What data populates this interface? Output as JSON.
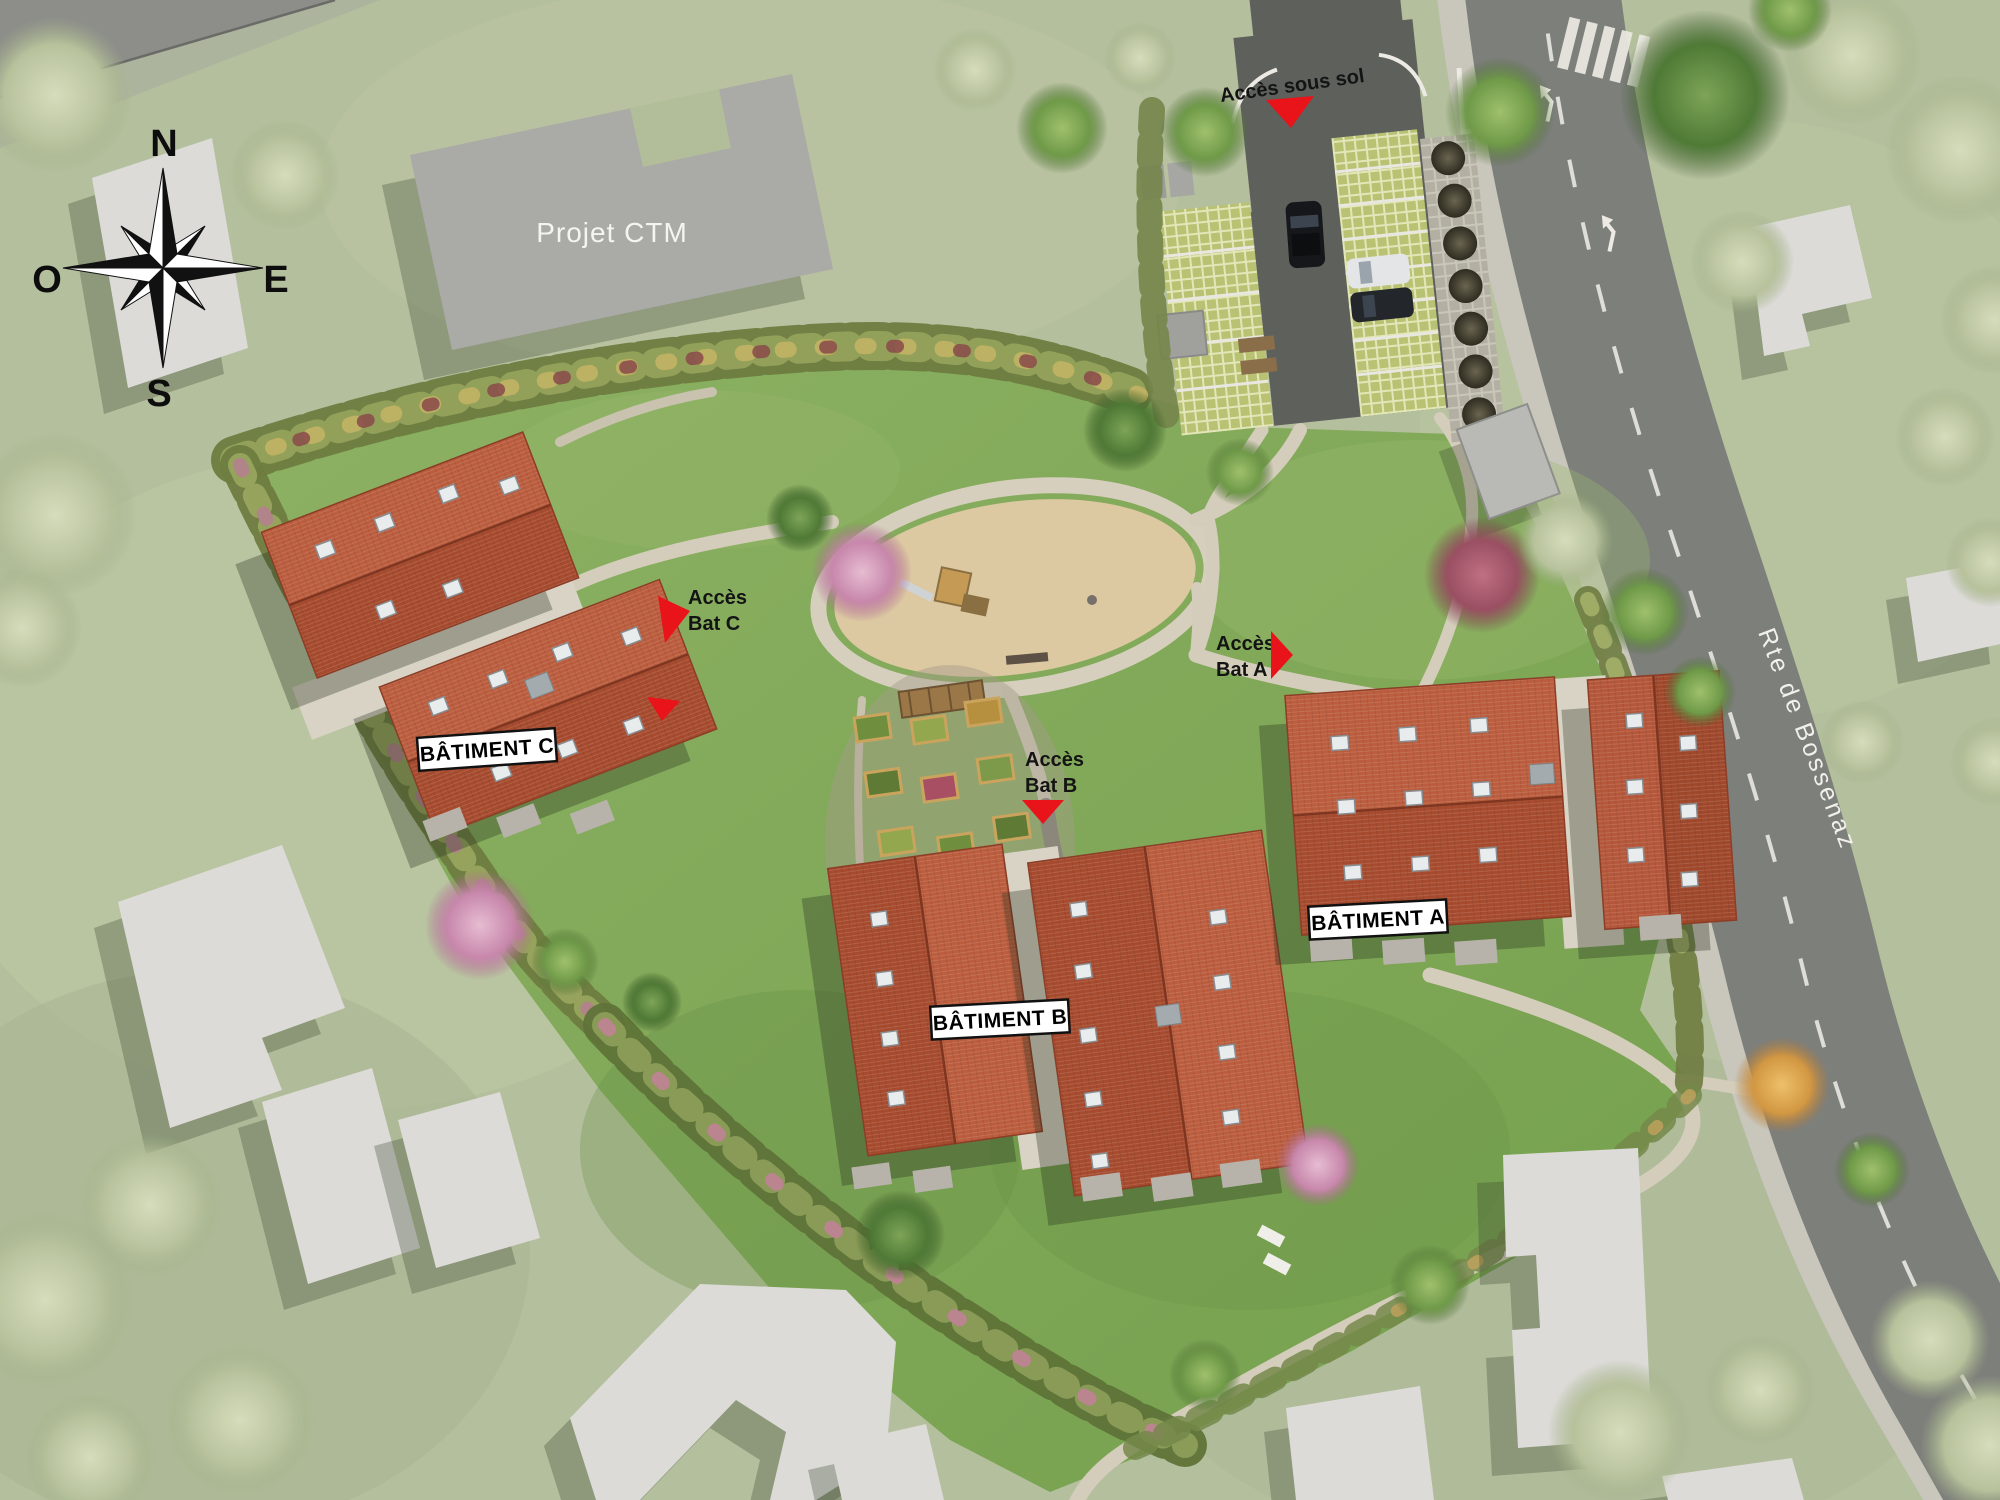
{
  "compass": {
    "north": "N",
    "east": "E",
    "south": "S",
    "west": "O"
  },
  "neighbor": {
    "projet_ctm": "Projet CTM"
  },
  "road": {
    "name": "Rte de Bossenaz"
  },
  "access": {
    "sous_sol": {
      "label": "Accès sous sol"
    },
    "bat_a": {
      "line1": "Accès",
      "line2": "Bat A"
    },
    "bat_b": {
      "line1": "Accès",
      "line2": "Bat B"
    },
    "bat_c": {
      "line1": "Accès",
      "line2": "Bat C"
    }
  },
  "buildings": {
    "a": "BÂTIMENT A",
    "b": "BÂTIMENT B",
    "c": "BÂTIMENT C"
  },
  "colors": {
    "accent_red": "#e8141a",
    "site_lawn": "#7fa855",
    "outer_lawn": "#b4bf9d",
    "roof_terracotta": "#b05232",
    "road_asphalt": "#7d7f7b",
    "parking_asphalt": "#5e605c",
    "neighbor_gray": "#dcdbd7",
    "path_beige": "#d4cdbb"
  }
}
